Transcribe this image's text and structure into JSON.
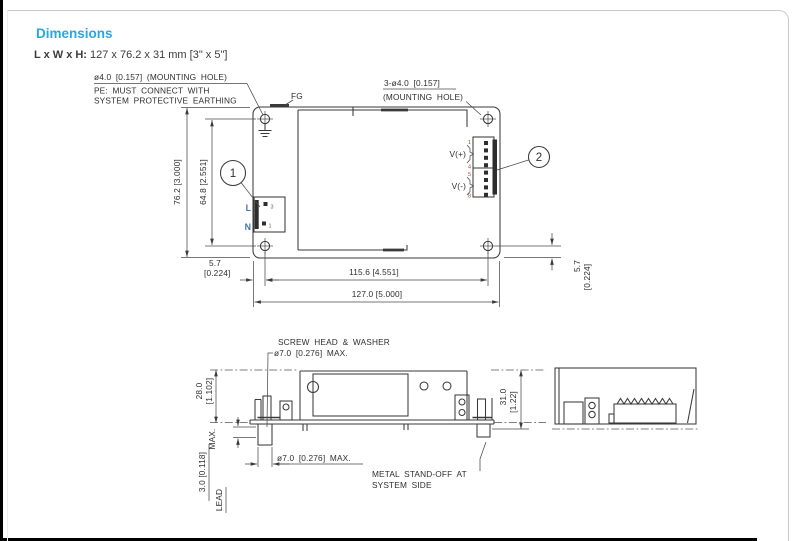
{
  "page": {
    "title": "Dimensions",
    "size_label": "L x W x H:",
    "size_value": "127 x 76.2 x 31 mm [3\" x 5\"]",
    "accent_color": "#2aa7dd",
    "label_blue": "#4273b4",
    "pin_number_color": "#8f4a3e"
  },
  "top_view": {
    "hole_note1": "ø4.0 [0.157] (MOUNTING HOLE)",
    "pe_note1": "PE: MUST CONNECT WITH",
    "pe_note2": "SYSTEM PROTECTIVE EARTHING",
    "fg": "FG",
    "hole_note2a": "3-ø4.0 [0.157]",
    "hole_note2b": "(MOUNTING HOLE)",
    "dim_76": "76.2 [3.000]",
    "dim_64": "64.8 [2.551]",
    "dim_57a": "5.7",
    "dim_57b": "[0.224]",
    "dim_115": "115.6 [4.551]",
    "dim_127": "127.0 [5.000]",
    "dim_57r_a": "5.7",
    "dim_57r_b": "[0.224]",
    "callout1": "1",
    "callout2": "2",
    "line": "L",
    "neutral": "N",
    "pin_in_top": "3",
    "pin_in_bottom": "1",
    "vplus": "V(+)",
    "vminus": "V(-)",
    "pin1": "1",
    "pin4": "4",
    "pin5": "5",
    "pin8": "8"
  },
  "side_view": {
    "screw_note1": "SCREW HEAD & WASHER",
    "screw_note2": "ø7.0 [0.276] MAX.",
    "dim_28a": "28.0",
    "dim_28b": "[1.102]",
    "dim_31a": "31.0",
    "dim_31b": "[1.22]",
    "dim_30": "3.0 [0.118]",
    "dim_30_max": "MAX.",
    "lead": "LEAD",
    "standoff_dim": "ø7.0 [0.276] MAX.",
    "standoff_note1": "METAL STAND-OFF AT",
    "standoff_note2": "SYSTEM SIDE"
  }
}
